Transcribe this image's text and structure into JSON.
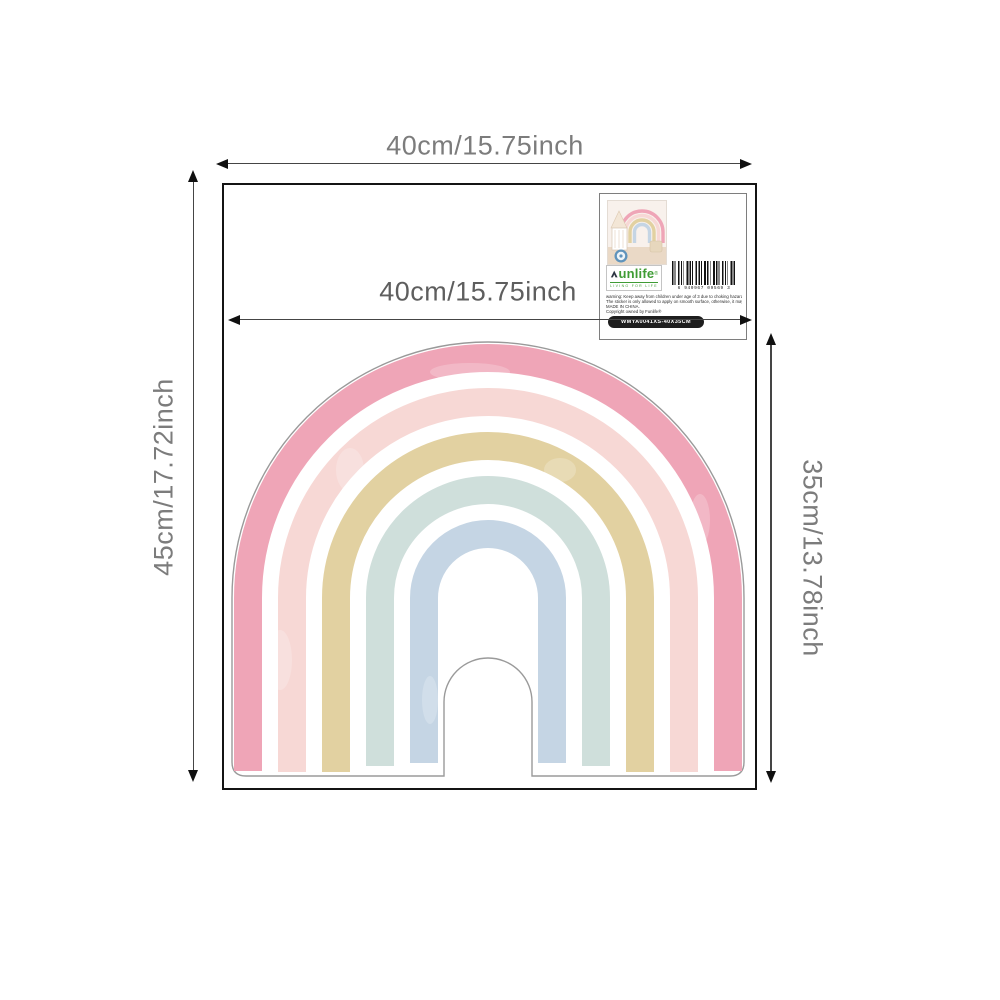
{
  "stage": {
    "background": "#ffffff"
  },
  "dimensions": {
    "top": {
      "label": "40cm/15.75inch"
    },
    "left": {
      "label": "45cm/17.72inch"
    },
    "inner": {
      "label": "40cm/15.75inch"
    },
    "right": {
      "label": "35cm/13.78inch"
    }
  },
  "sticker": {
    "type": "watercolor-rainbow-wall-decal",
    "band_colors": [
      "#efa5b7",
      "#f7d8d5",
      "#e2d1a1",
      "#cfdfdb",
      "#c5d5e4"
    ],
    "outline_color": "#9a9a9a"
  },
  "packaging_card": {
    "brand": "unlife",
    "brand_full": "Funlife",
    "brand_color": "#3f9c35",
    "reg_mark": "®",
    "tagline": "LIVING FOR LIFE",
    "barcode_digits": "6 940967 09569 3",
    "warnings": [
      "warning: Keep away from children under age of 3 due to choking hazard.",
      "The sticker is only allowed to apply on smooth surface, otherwise, it may fall off easily.",
      "MADE IN CHINA.",
      "Copyright owned by Funlife®"
    ],
    "sku_label": "WMYA0041XS-40X35CM"
  }
}
